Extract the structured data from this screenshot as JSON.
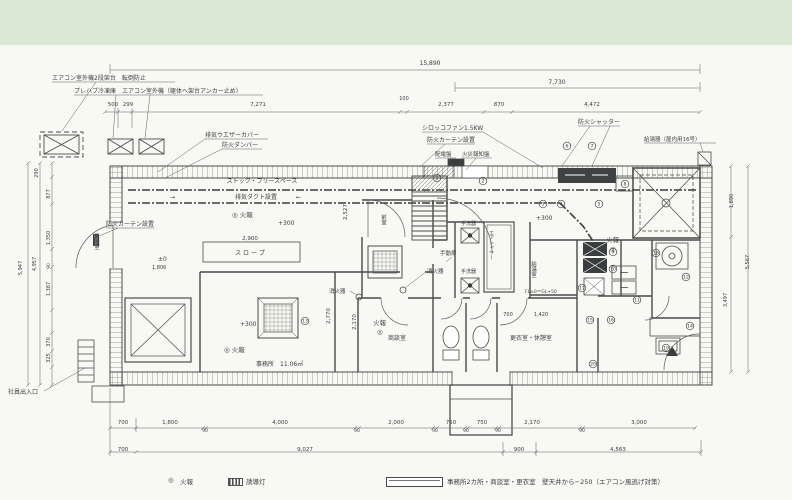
{
  "colors": {
    "band": "#d9e9d5",
    "paper": "#f8f9f3",
    "line": "#45494a",
    "dark": "#3a3d3e"
  },
  "legend": {
    "fire_symbol": "◎",
    "fire_label": "火報",
    "guide_label": "誘導灯",
    "note": "事務所2カ所・商談室・更衣室　壁天井から−250（エアコン風逃げ対策）"
  },
  "plan": {
    "labels": [
      {
        "n": "note-ac-outdoor-stand",
        "t": "エアコン室外機2段架台　転倒防止",
        "x": 52,
        "y": 80,
        "s": 6
      },
      {
        "n": "note-prefab-freezer",
        "t": "プレハブ冷凍庫　エアコン室外機（躯体へ架台アンカー止め）",
        "x": 74,
        "y": 93,
        "s": 6
      },
      {
        "n": "dim",
        "t": "500",
        "x": 113,
        "y": 106,
        "s": 5.5,
        "a": "middle"
      },
      {
        "n": "dim",
        "t": "299",
        "x": 128,
        "y": 106,
        "s": 5.5,
        "a": "middle"
      },
      {
        "n": "dim-overall-width",
        "t": "15,890",
        "x": 430,
        "y": 65,
        "s": 6,
        "a": "middle"
      },
      {
        "n": "dim",
        "t": "7,730",
        "x": 557,
        "y": 84,
        "s": 6,
        "a": "middle"
      },
      {
        "n": "dim",
        "t": "7,271",
        "x": 258,
        "y": 106,
        "s": 5.5,
        "a": "middle"
      },
      {
        "n": "dim",
        "t": "100",
        "x": 404,
        "y": 100,
        "s": 5,
        "a": "middle"
      },
      {
        "n": "dim",
        "t": "2,377",
        "x": 446,
        "y": 106,
        "s": 5.5,
        "a": "middle"
      },
      {
        "n": "dim",
        "t": "870",
        "x": 499,
        "y": 106,
        "s": 5.5,
        "a": "middle"
      },
      {
        "n": "dim",
        "t": "4,472",
        "x": 592,
        "y": 106,
        "s": 5.5,
        "a": "middle"
      },
      {
        "n": "note-exhaust-weather-cover",
        "t": "排気ウエザーカバー",
        "x": 205,
        "y": 137,
        "s": 6
      },
      {
        "n": "note-fire-damper",
        "t": "防火ダンパー",
        "x": 222,
        "y": 147,
        "s": 6
      },
      {
        "n": "note-sirocco-fan",
        "t": "シロッコファン1.5KW",
        "x": 422,
        "y": 130,
        "s": 6
      },
      {
        "n": "note-fire-curtain-top",
        "t": "防火カーテン設置",
        "x": 427,
        "y": 142,
        "s": 6
      },
      {
        "n": "note-switchboard",
        "t": "配電盤",
        "x": 435,
        "y": 156,
        "s": 5.5
      },
      {
        "n": "note-fire-alarm-panel",
        "t": "火災報知盤",
        "x": 462,
        "y": 156,
        "s": 5.5
      },
      {
        "n": "note-fire-shutter",
        "t": "防火シャッター",
        "x": 578,
        "y": 124,
        "s": 6
      },
      {
        "n": "note-water-heater",
        "t": "給湯器（屋内用16号）",
        "x": 644,
        "y": 141,
        "s": 5.5
      },
      {
        "n": "room-stock-free-space",
        "t": "ストック・フリースペース",
        "x": 262,
        "y": 183,
        "s": 6,
        "a": "middle"
      },
      {
        "n": "note-exhaust-duct",
        "t": "排気ダクト設置",
        "x": 256,
        "y": 199,
        "s": 6,
        "a": "middle"
      },
      {
        "n": "arrow",
        "t": "→",
        "x": 170,
        "y": 199,
        "s": 6
      },
      {
        "n": "arrow",
        "t": "←",
        "x": 296,
        "y": 199,
        "s": 6
      },
      {
        "n": "fire-alarm-mark",
        "t": "◎ 火報",
        "x": 232,
        "y": 217,
        "s": 6.5
      },
      {
        "n": "level",
        "t": "+300",
        "x": 278,
        "y": 225,
        "s": 6
      },
      {
        "n": "dim",
        "t": "2,527",
        "x": 347,
        "y": 212,
        "s": 5.5,
        "a": "middle",
        "r": -90
      },
      {
        "n": "note-fire-curtain-left",
        "t": "防火カーテン設置",
        "x": 106,
        "y": 226,
        "s": 6
      },
      {
        "n": "room-windbreak",
        "t": "風除室",
        "x": 96,
        "y": 233,
        "s": 5.5,
        "v": 1
      },
      {
        "n": "dim",
        "t": "2,900",
        "x": 250,
        "y": 240,
        "s": 5.5,
        "a": "middle"
      },
      {
        "n": "note-slope",
        "t": "ス ロ ー プ",
        "x": 250,
        "y": 255,
        "s": 6,
        "a": "middle"
      },
      {
        "n": "level",
        "t": "±0",
        "x": 158,
        "y": 261,
        "s": 6
      },
      {
        "n": "dim",
        "t": "1,806",
        "x": 152,
        "y": 269,
        "s": 5
      },
      {
        "n": "room-anteroom",
        "t": "前室",
        "x": 383,
        "y": 214,
        "s": 5.5,
        "v": 1
      },
      {
        "n": "note-manual-door",
        "t": "手動扉",
        "x": 440,
        "y": 255,
        "s": 5.5
      },
      {
        "n": "note-extinguisher",
        "t": "消火器",
        "x": 427,
        "y": 273,
        "s": 5.5
      },
      {
        "n": "note-hand-basin",
        "t": "手洗器",
        "x": 461,
        "y": 225,
        "s": 5
      },
      {
        "n": "note-hand-basin",
        "t": "手洗器",
        "x": 461,
        "y": 273,
        "s": 5
      },
      {
        "n": "room-air-shower",
        "t": "エアシャワー",
        "x": 491,
        "y": 230,
        "s": 5,
        "v": 1
      },
      {
        "n": "room-kitchenette",
        "t": "給湯室",
        "x": 533,
        "y": 261,
        "s": 5.5,
        "v": 1
      },
      {
        "n": "note-extinguisher",
        "t": "消火器",
        "x": 329,
        "y": 293,
        "s": 5.5
      },
      {
        "n": "level",
        "t": "+300",
        "x": 536,
        "y": 220,
        "s": 6
      },
      {
        "n": "fire-alarm-mark",
        "t": "火報",
        "x": 606,
        "y": 242,
        "s": 6.5
      },
      {
        "n": "fire-alarm-mark",
        "t": "◎",
        "x": 610,
        "y": 251,
        "s": 6.5
      },
      {
        "n": "level-note",
        "t": "FL±0＝GL+50",
        "x": 525,
        "y": 293,
        "s": 4.5
      },
      {
        "n": "level",
        "t": "+300",
        "x": 240,
        "y": 326,
        "s": 6
      },
      {
        "n": "fire-alarm-mark",
        "t": "◎ 火報",
        "x": 224,
        "y": 352,
        "s": 6.5
      },
      {
        "n": "room-office",
        "t": "事務所　11.06㎡",
        "x": 256,
        "y": 366,
        "s": 6
      },
      {
        "n": "fire-alarm-mark",
        "t": "火報",
        "x": 373,
        "y": 325,
        "s": 6.5
      },
      {
        "n": "fire-alarm-mark",
        "t": "◎",
        "x": 377,
        "y": 334,
        "s": 6.5
      },
      {
        "n": "room-meeting",
        "t": "商談室",
        "x": 388,
        "y": 340,
        "s": 6
      },
      {
        "n": "dim",
        "t": "2,770",
        "x": 330,
        "y": 316,
        "s": 5.5,
        "a": "middle",
        "r": -90
      },
      {
        "n": "dim",
        "t": "2,170",
        "x": 356,
        "y": 322,
        "s": 5.5,
        "a": "middle",
        "r": -90
      },
      {
        "n": "room-locker-rest",
        "t": "更衣室・休憩室",
        "x": 510,
        "y": 340,
        "s": 6
      },
      {
        "n": "dim",
        "t": "700",
        "x": 508,
        "y": 316,
        "s": 5,
        "a": "middle"
      },
      {
        "n": "dim",
        "t": "1,420",
        "x": 541,
        "y": 316,
        "s": 5,
        "a": "middle"
      },
      {
        "n": "note-staff-entrance",
        "t": "社員出入口",
        "x": 8,
        "y": 394,
        "s": 6
      },
      {
        "n": "dim",
        "t": "290",
        "x": 38,
        "y": 173,
        "s": 5,
        "a": "middle",
        "r": -90
      },
      {
        "n": "dim",
        "t": "877",
        "x": 50,
        "y": 194,
        "s": 5,
        "a": "middle",
        "r": -90
      },
      {
        "n": "dim",
        "t": "1,350",
        "x": 50,
        "y": 238,
        "s": 5,
        "a": "middle",
        "r": -90
      },
      {
        "n": "dim",
        "t": "90",
        "x": 50,
        "y": 266,
        "s": 4.5,
        "a": "middle",
        "r": -90
      },
      {
        "n": "dim",
        "t": "1,387",
        "x": 50,
        "y": 289,
        "s": 5,
        "a": "middle",
        "r": -90
      },
      {
        "n": "dim",
        "t": "370",
        "x": 50,
        "y": 342,
        "s": 5,
        "a": "middle",
        "r": -90
      },
      {
        "n": "dim",
        "t": "325",
        "x": 50,
        "y": 358,
        "s": 5,
        "a": "middle",
        "r": -90
      },
      {
        "n": "dim",
        "t": "4,957",
        "x": 36,
        "y": 264,
        "s": 5,
        "a": "middle",
        "r": -90
      },
      {
        "n": "dim",
        "t": "5,947",
        "x": 22,
        "y": 268,
        "s": 5,
        "a": "middle",
        "r": -90
      },
      {
        "n": "dim",
        "t": "1,890",
        "x": 733,
        "y": 201,
        "s": 5,
        "a": "middle",
        "r": -90
      },
      {
        "n": "dim",
        "t": "3,497",
        "x": 727,
        "y": 300,
        "s": 5,
        "a": "middle",
        "r": -90
      },
      {
        "n": "dim",
        "t": "5,567",
        "x": 749,
        "y": 262,
        "s": 5,
        "a": "middle",
        "r": -90
      },
      {
        "n": "dim",
        "t": "700",
        "x": 123,
        "y": 424,
        "s": 5.5,
        "a": "middle"
      },
      {
        "n": "dim",
        "t": "1,800",
        "x": 170,
        "y": 424,
        "s": 5.5,
        "a": "middle"
      },
      {
        "n": "dim",
        "t": "4,000",
        "x": 280,
        "y": 424,
        "s": 5.5,
        "a": "middle"
      },
      {
        "n": "dim",
        "t": "2,000",
        "x": 396,
        "y": 424,
        "s": 5.5,
        "a": "middle"
      },
      {
        "n": "dim",
        "t": "750",
        "x": 451,
        "y": 424,
        "s": 5.5,
        "a": "middle"
      },
      {
        "n": "dim",
        "t": "750",
        "x": 482,
        "y": 424,
        "s": 5.5,
        "a": "middle"
      },
      {
        "n": "dim",
        "t": "2,170",
        "x": 532,
        "y": 424,
        "s": 5.5,
        "a": "middle"
      },
      {
        "n": "dim",
        "t": "3,000",
        "x": 639,
        "y": 424,
        "s": 5.5,
        "a": "middle"
      },
      {
        "n": "dim",
        "t": "90",
        "x": 205,
        "y": 432,
        "s": 4.5,
        "a": "middle"
      },
      {
        "n": "dim",
        "t": "90",
        "x": 357,
        "y": 432,
        "s": 4.5,
        "a": "middle"
      },
      {
        "n": "dim",
        "t": "90",
        "x": 435,
        "y": 432,
        "s": 4.5,
        "a": "middle"
      },
      {
        "n": "dim",
        "t": "90",
        "x": 466,
        "y": 432,
        "s": 4.5,
        "a": "middle"
      },
      {
        "n": "dim",
        "t": "90",
        "x": 498,
        "y": 432,
        "s": 4.5,
        "a": "middle"
      },
      {
        "n": "dim",
        "t": "90",
        "x": 582,
        "y": 432,
        "s": 4.5,
        "a": "middle"
      },
      {
        "n": "dim",
        "t": "700",
        "x": 123,
        "y": 451,
        "s": 5.5,
        "a": "middle"
      },
      {
        "n": "dim",
        "t": "9,027",
        "x": 305,
        "y": 451,
        "s": 5.5,
        "a": "middle"
      },
      {
        "n": "dim",
        "t": "900",
        "x": 519,
        "y": 451,
        "s": 5.5,
        "a": "middle"
      },
      {
        "n": "dim",
        "t": "4,563",
        "x": 618,
        "y": 451,
        "s": 5.5,
        "a": "middle"
      },
      {
        "n": "circled-number-1",
        "t": "1",
        "x": 437,
        "y": 178,
        "c": 1
      },
      {
        "n": "circled-number-2",
        "t": "2",
        "x": 483,
        "y": 181,
        "c": 1
      },
      {
        "n": "circled-number-3",
        "t": "3",
        "x": 543,
        "y": 204,
        "c": 1
      },
      {
        "n": "circled-number-4",
        "t": "4",
        "x": 561,
        "y": 204,
        "c": 1
      },
      {
        "n": "circled-number-5",
        "t": "5",
        "x": 599,
        "y": 204,
        "c": 1
      },
      {
        "n": "circled-number-6",
        "t": "6",
        "x": 567,
        "y": 146,
        "c": 1
      },
      {
        "n": "circled-number-7",
        "t": "7",
        "x": 592,
        "y": 146,
        "c": 1
      },
      {
        "n": "circled-number-8",
        "t": "8",
        "x": 625,
        "y": 184,
        "c": 1
      },
      {
        "n": "circled-number-9",
        "t": "9",
        "x": 613,
        "y": 252,
        "c": 1
      },
      {
        "n": "circled-number-10",
        "t": "10",
        "x": 613,
        "y": 269,
        "c": 1
      },
      {
        "n": "circled-number-17",
        "t": "17",
        "x": 582,
        "y": 288,
        "c": 1
      },
      {
        "n": "circled-number-11",
        "t": "11",
        "x": 637,
        "y": 300,
        "c": 1
      },
      {
        "n": "circled-number-18",
        "t": "18",
        "x": 656,
        "y": 253,
        "c": 1
      },
      {
        "n": "circled-number-19",
        "t": "19",
        "x": 666,
        "y": 348,
        "c": 1
      },
      {
        "n": "circled-number-15",
        "t": "15",
        "x": 590,
        "y": 320,
        "c": 1
      },
      {
        "n": "circled-number-16",
        "t": "16",
        "x": 611,
        "y": 320,
        "c": 1
      },
      {
        "n": "circled-number-20",
        "t": "20",
        "x": 593,
        "y": 364,
        "c": 1
      },
      {
        "n": "circled-number-12",
        "t": "12",
        "x": 686,
        "y": 277,
        "c": 1
      },
      {
        "n": "circled-number-14",
        "t": "14",
        "x": 690,
        "y": 326,
        "c": 1
      },
      {
        "n": "circled-number-13",
        "t": "13",
        "x": 305,
        "y": 321,
        "c": 1
      }
    ]
  }
}
